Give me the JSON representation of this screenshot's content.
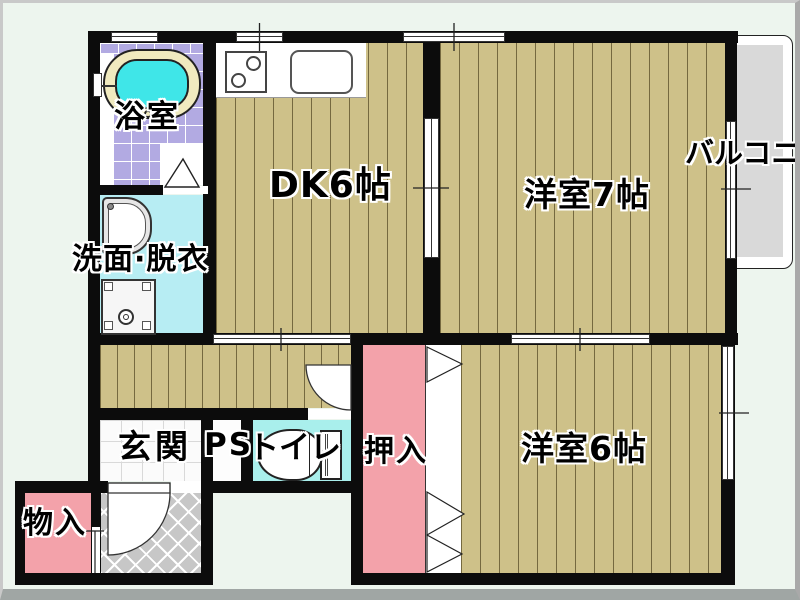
{
  "plan": {
    "rooms": {
      "bath": {
        "label": "浴室"
      },
      "washroom": {
        "label": "洗面·脱衣"
      },
      "dining_kitchen": {
        "label": "DK6帖"
      },
      "western_room_7": {
        "label": "洋室7帖"
      },
      "balcony": {
        "label": "バルコニー"
      },
      "entrance": {
        "label": "玄関"
      },
      "pipe_space": {
        "label": "PS"
      },
      "toilet": {
        "label": "トイレ"
      },
      "closet": {
        "label": "押入"
      },
      "western_room_6": {
        "label": "洋室6帖"
      },
      "storage": {
        "label": "物入"
      }
    },
    "fixtures": [
      "bathtub",
      "washbasin",
      "washing-machine",
      "kitchen-stove",
      "kitchen-sink",
      "toilet-bowl",
      "entrance-door",
      "toilet-door",
      "bath-door",
      "closet-folding-door"
    ],
    "colors": {
      "wall": "#0c0c0c",
      "wood_floor": "#cec189",
      "plank_line": "#75693f",
      "bath_tile": "#b2aae2",
      "tub_water": "#3fe6e8",
      "tub_rim": "#f0eabf",
      "washroom_floor": "#b7edf3",
      "toilet_floor": "#a9efec",
      "closet_pink": "#f3a2aa",
      "porch_gray": "#c7c7c7",
      "balcony_gray": "#d9d9d9",
      "background": "#edf5ee"
    }
  }
}
